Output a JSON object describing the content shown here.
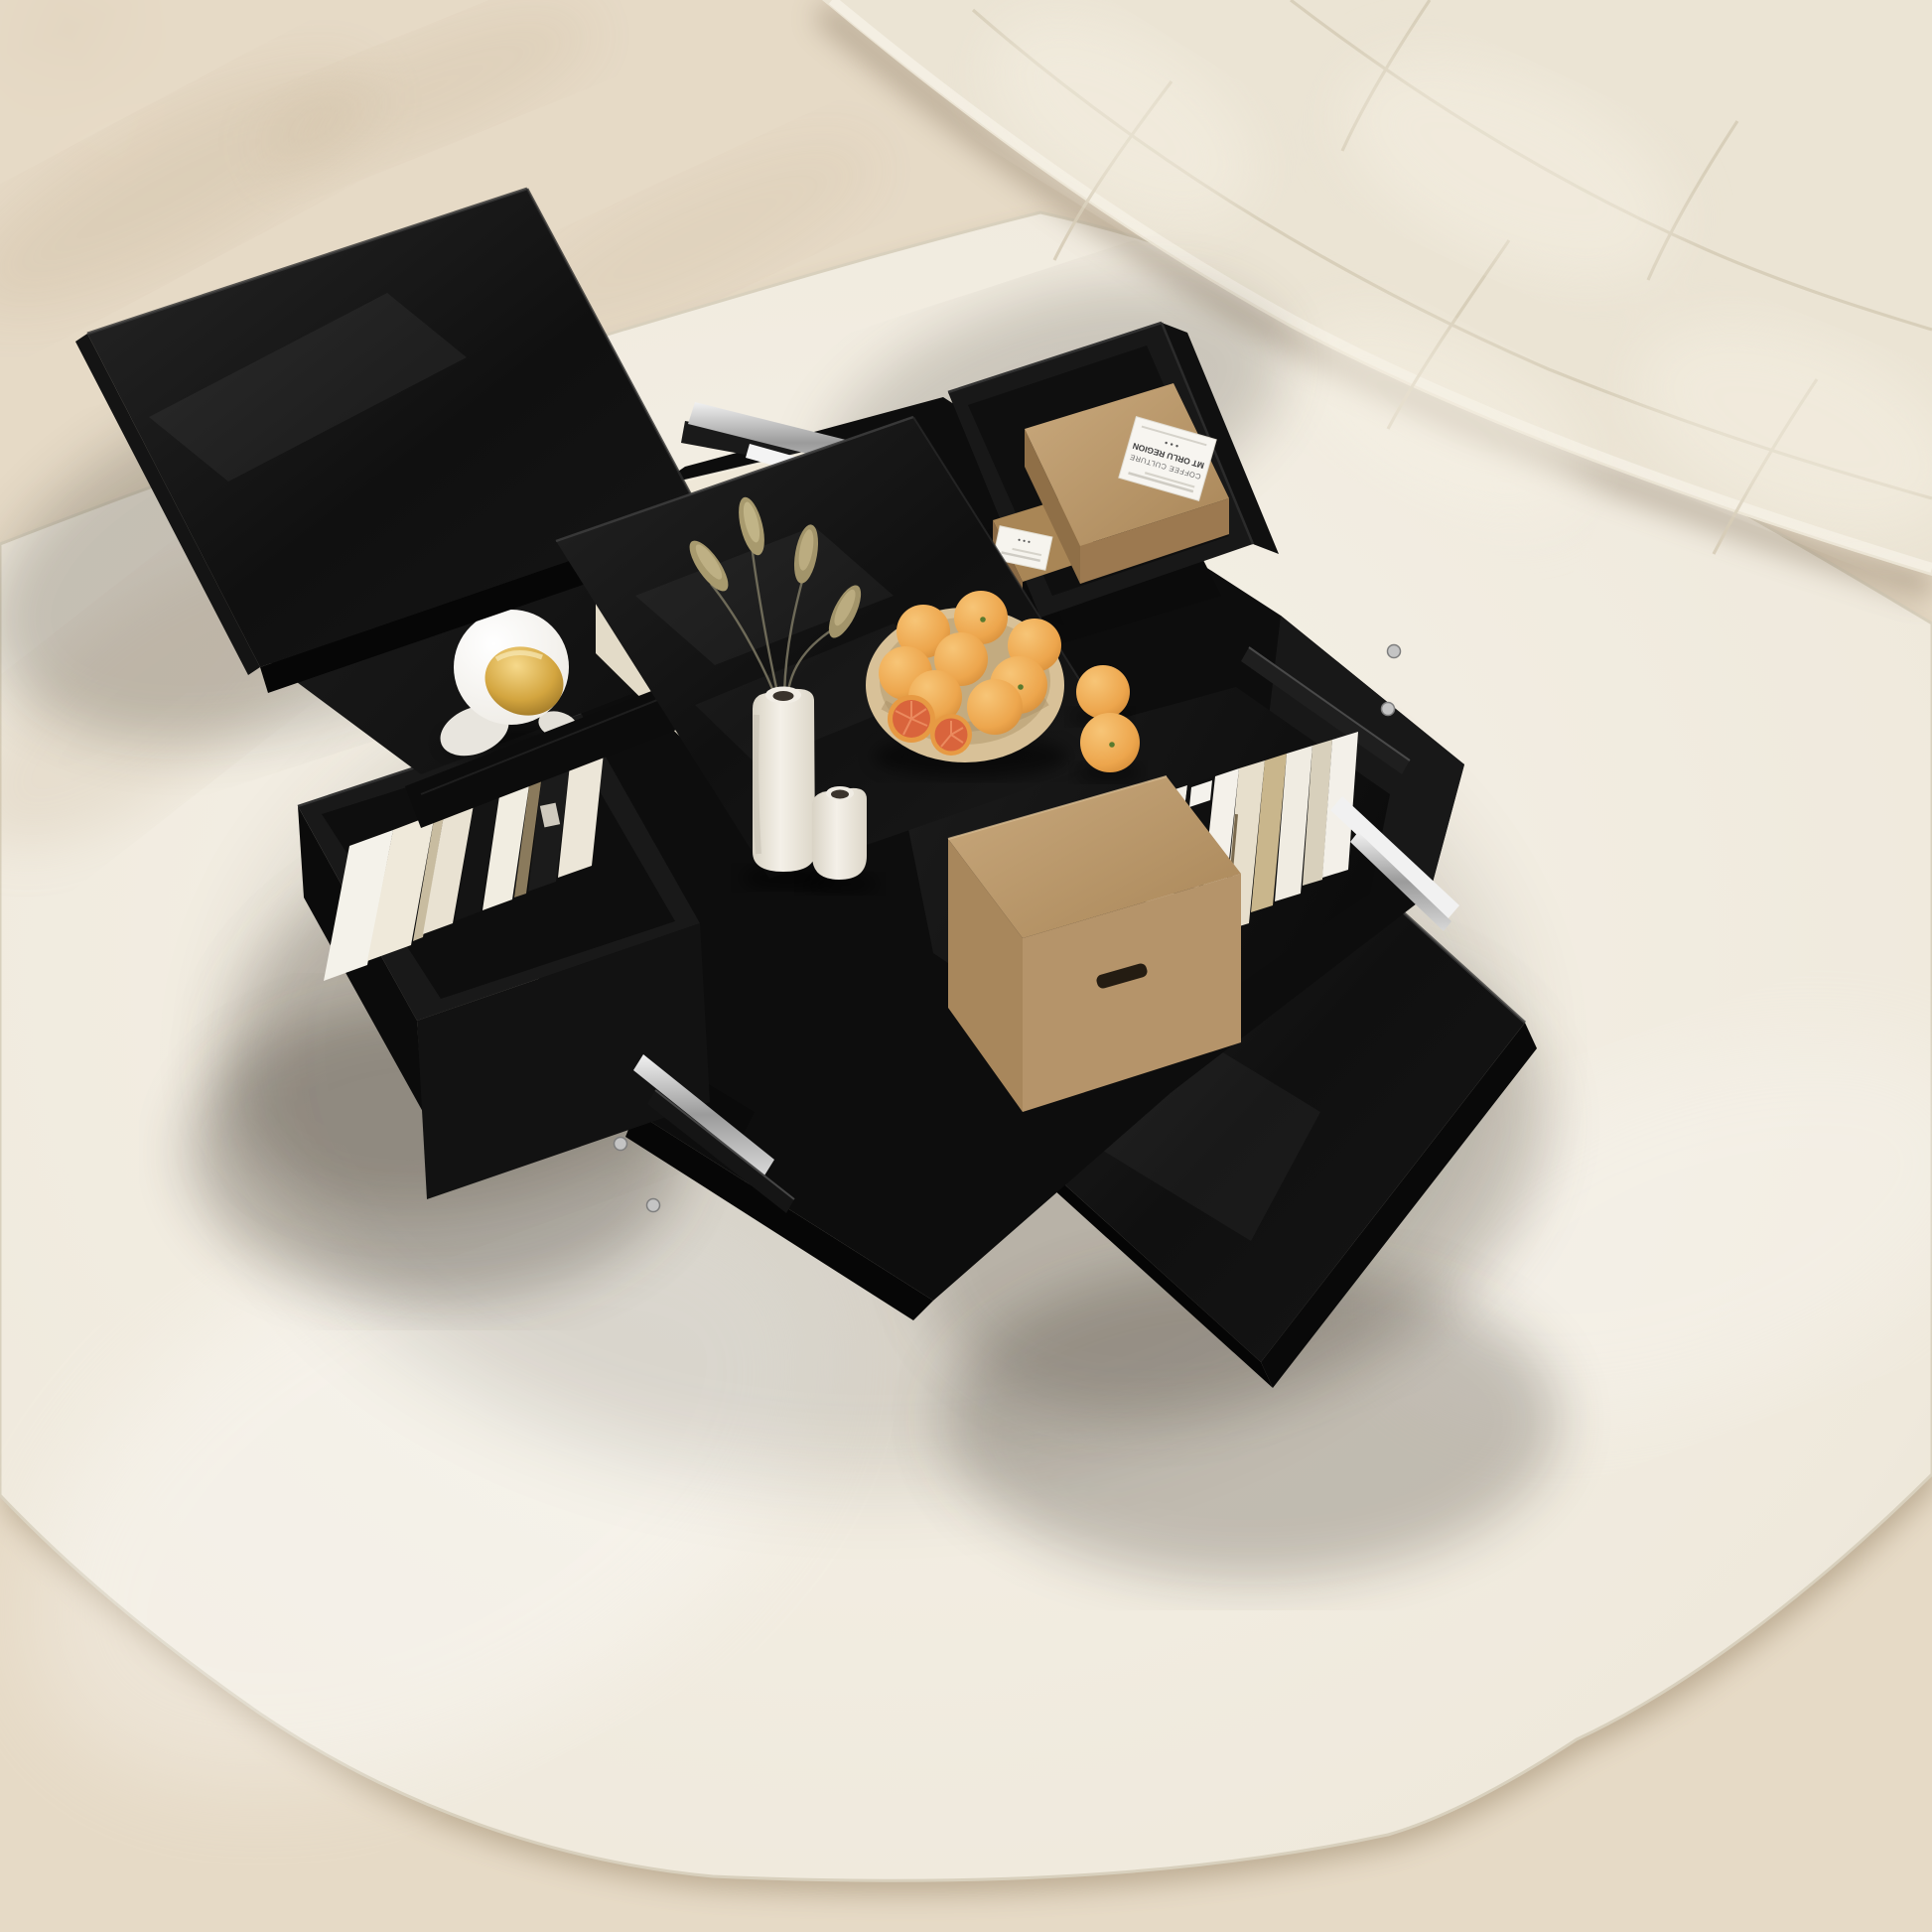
{
  "scene": {
    "type": "product-photograph",
    "title": "Black high-gloss coffee table with sliding tops and hidden storage",
    "setting": "round ivory rug over light herringbone wood floor beside a cream boucle sofa",
    "camera": "top-down three-quarter view"
  },
  "palette": {
    "table_black": "#121212",
    "gloss_highlight": "#2a2a2a",
    "rug_ivory": "#f2ede2",
    "floor_wood": "#e5d9c3",
    "sofa_cream": "#ebe4d4",
    "kraft_brown": "#b8946a",
    "orange_fruit": "#eda64d",
    "blood_orange_flesh": "#d9643c",
    "ceramic_white": "#efeae1",
    "visor_gold": "#d8ab46",
    "grass_beige": "#a89a6e",
    "rail_silver": "#d6d6d6"
  },
  "labels": {
    "coffee_box": {
      "line1": "COFFEE CULTURE",
      "line2": "MT ORLU REGION",
      "dots": "• • •"
    },
    "se_book_spine": "CH"
  },
  "objects": {
    "table": "4-way sliding-top coffee table, high gloss black",
    "nw_compartment": [
      "cream gift box",
      "astronaut figurine with gold visor"
    ],
    "ne_drawer": [
      "two kraft coffee boxes with white labels"
    ],
    "sw_drawer": [
      "row of books, white/cream/black spines"
    ],
    "se_compartment": [
      "kraft storage box with handle slot",
      "row of books"
    ],
    "tabletop": [
      "tall ceramic vase with bunny-tail grass",
      "small ceramic vase",
      "bowl of oranges with two halved blood oranges",
      "two loose oranges"
    ]
  }
}
